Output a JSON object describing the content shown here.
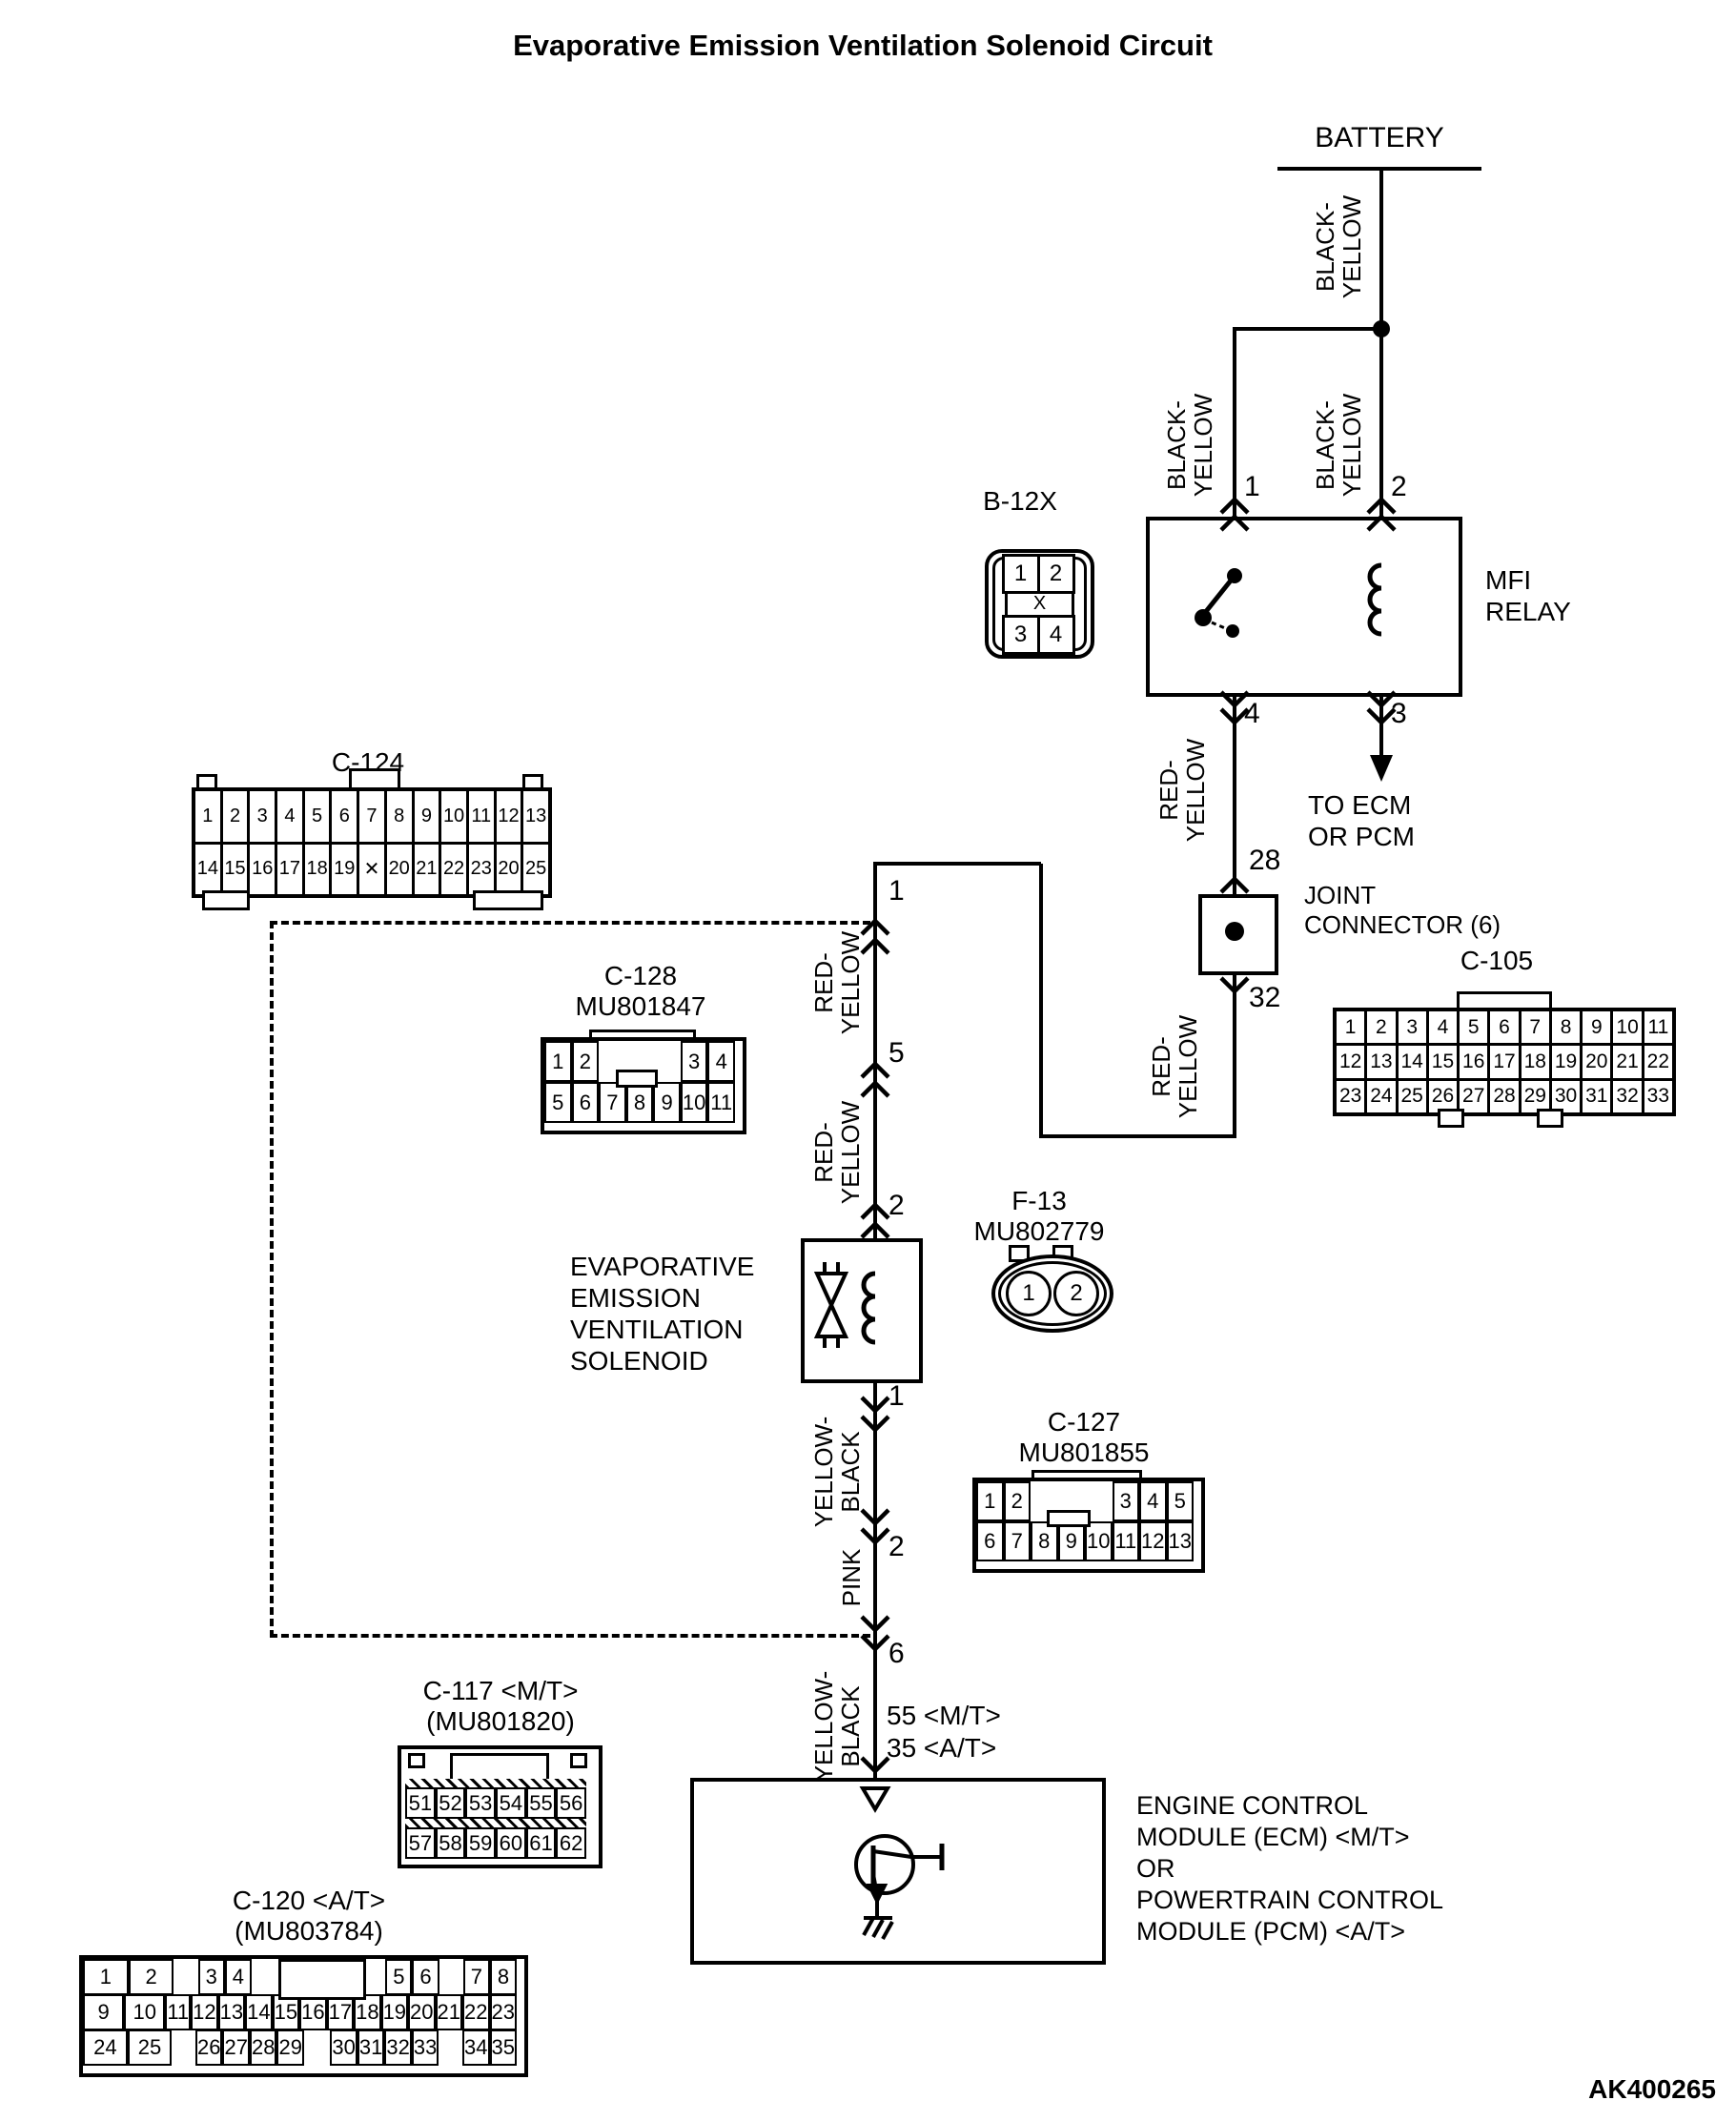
{
  "title": "Evaporative Emission Ventilation Solenoid Circuit",
  "footer_code": "AK400265",
  "battery": {
    "label": "BATTERY"
  },
  "wire_colors": {
    "black_yellow": {
      "l1": "BLACK-",
      "l2": "YELLOW"
    },
    "red_yellow": {
      "l1": "RED-",
      "l2": "YELLOW"
    },
    "yellow_black": {
      "l1": "YELLOW-",
      "l2": "BLACK"
    },
    "pink": {
      "l1": "PINK"
    }
  },
  "relay": {
    "name_l1": "MFI",
    "name_l2": "RELAY",
    "pins": {
      "in_left": "1",
      "in_right": "2",
      "out_left": "4",
      "out_right": "3"
    }
  },
  "to_ecm": {
    "l1": "TO ECM",
    "l2": "OR PCM"
  },
  "joint": {
    "l1": "JOINT",
    "l2": "CONNECTOR (6)",
    "pin_in": "28",
    "pin_out": "32"
  },
  "spine": {
    "pins": {
      "p1": "1",
      "p5": "5",
      "p2": "2",
      "sol_out": "1",
      "pink_in": "2",
      "p6": "6"
    },
    "ecm_pin_mt": "55 <M/T>",
    "ecm_pin_at": "35 <A/T>"
  },
  "solenoid": {
    "lines": [
      "EVAPORATIVE",
      "EMISSION",
      "VENTILATION",
      "SOLENOID"
    ]
  },
  "ecm": {
    "lines": [
      "ENGINE CONTROL",
      "MODULE (ECM) <M/T>",
      "OR",
      "POWERTRAIN CONTROL",
      "MODULE (PCM) <A/T>"
    ]
  },
  "connectors": {
    "b12x": {
      "name": "B-12X",
      "row_top": [
        "1",
        "2"
      ],
      "row_bottom": [
        "3",
        "4"
      ],
      "cross": "X"
    },
    "c105": {
      "name": "C-105",
      "rows": [
        [
          "1",
          "2",
          "3",
          "4",
          "5",
          "6",
          "7",
          "8",
          "9",
          "10",
          "11"
        ],
        [
          "12",
          "13",
          "14",
          "15",
          "16",
          "17",
          "18",
          "19",
          "20",
          "21",
          "22"
        ],
        [
          "23",
          "24",
          "25",
          "26",
          "27",
          "28",
          "29",
          "30",
          "31",
          "32",
          "33"
        ]
      ]
    },
    "c124": {
      "name": "C-124",
      "rows": [
        [
          "1",
          "2",
          "3",
          "4",
          "5",
          "6",
          "7",
          "8",
          "9",
          "10",
          "11",
          "12",
          "13"
        ],
        [
          "14",
          "15",
          "16",
          "17",
          "18",
          "19",
          "✕",
          "20",
          "21",
          "22",
          "23",
          "20",
          "25"
        ]
      ]
    },
    "c128": {
      "name": "C-128",
      "code": "MU801847",
      "row_top": [
        "1",
        "2",
        "",
        "",
        "",
        "3",
        "4"
      ],
      "row_bottom": [
        "5",
        "6",
        "7",
        "8",
        "9",
        "10",
        "11"
      ]
    },
    "f13": {
      "name": "F-13",
      "code": "MU802779",
      "cavities": [
        "1",
        "2"
      ]
    },
    "c127": {
      "name": "C-127",
      "code": "MU801855",
      "row_top": [
        "1",
        "2",
        "",
        "",
        "",
        "3",
        "4",
        "5"
      ],
      "row_bottom": [
        "6",
        "7",
        "8",
        "9",
        "10",
        "11",
        "12",
        "13"
      ]
    },
    "c117": {
      "name": "C-117 <M/T>",
      "code": "(MU801820)",
      "rows": [
        [
          "51",
          "52",
          "53",
          "54",
          "55",
          "56"
        ],
        [
          "57",
          "58",
          "59",
          "60",
          "61",
          "62"
        ]
      ]
    },
    "c120": {
      "name": "C-120 <A/T>",
      "code": "(MU803784)",
      "rows": [
        [
          "1",
          "2",
          "",
          "3",
          "4",
          "",
          "",
          "",
          "",
          "",
          "5",
          "6",
          "",
          "7",
          "8"
        ],
        [
          "9",
          "10",
          "11",
          "12",
          "13",
          "14",
          "15",
          "16",
          "17",
          "18",
          "19",
          "20",
          "21",
          "22",
          "23"
        ],
        [
          "24",
          "25",
          "",
          "26",
          "27",
          "28",
          "29",
          "",
          "30",
          "31",
          "32",
          "33",
          "",
          "34",
          "35"
        ]
      ]
    }
  }
}
